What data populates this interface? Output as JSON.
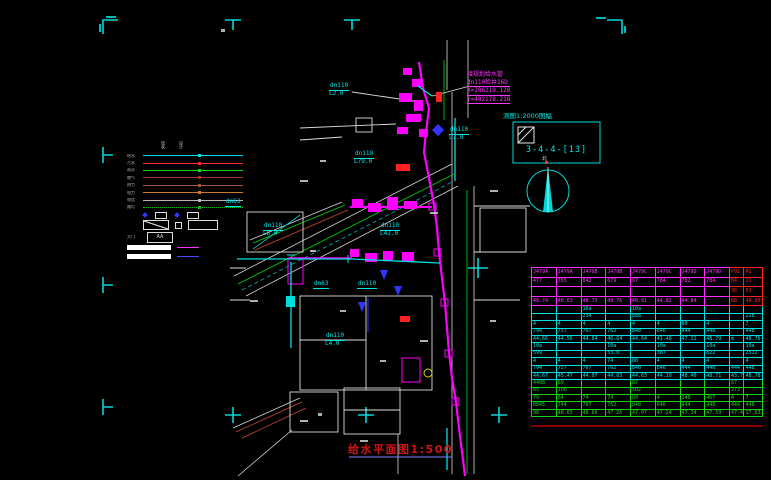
{
  "meta": {
    "background": "#000000",
    "accent_cyan": "#00e5e5",
    "accent_magenta": "#ff00ff",
    "accent_green": "#00d400",
    "accent_red": "#ff2020",
    "accent_white": "#e0e0e0"
  },
  "title": {
    "text": "给水平面图1:500"
  },
  "detail_box": {
    "scale_label": "测图1:2000图幅",
    "sheet_number": "3-4-4-[13]"
  },
  "compass": {
    "label": "北"
  },
  "coord_label": {
    "lines": [
      "接规划给水管",
      "dn110检井16D",
      "X=286219.128",
      "Y=482178.218"
    ]
  },
  "legend": {
    "header": [
      "现状",
      "设计"
    ],
    "lines": [
      {
        "label": "给水",
        "color": "#00e0e0",
        "dotted": false
      },
      {
        "label": "污水",
        "color": "#ff2a2a",
        "dotted": false
      },
      {
        "label": "雨水",
        "color": "#17d417",
        "dotted": false
      },
      {
        "label": "燃气",
        "color": "#a03828",
        "dotted": false
      },
      {
        "label": "热力",
        "color": "#a85535",
        "dotted": false
      },
      {
        "label": "电力",
        "color": "#cc7a2e",
        "dotted": false
      },
      {
        "label": "电信",
        "color": "#b8b8b8",
        "dotted": false
      },
      {
        "label": "路灯",
        "color": "#18b818",
        "dotted": true
      }
    ],
    "aa_row_label": "大门",
    "box_text": "AA"
  },
  "map_labels": [
    {
      "text": "dn110",
      "sub": "L2.0",
      "x": 329,
      "y": 83
    },
    {
      "text": "dn110",
      "sub": "L79.0",
      "x": 354,
      "y": 151
    },
    {
      "text": "dn110",
      "sub": "L7.0",
      "x": 449,
      "y": 127
    },
    {
      "text": "dn63",
      "sub": "",
      "x": 225,
      "y": 199
    },
    {
      "text": "dn110",
      "sub": "L8.0",
      "x": 263,
      "y": 223
    },
    {
      "text": "dn110",
      "sub": "L42.0",
      "x": 380,
      "y": 223
    },
    {
      "text": "dn63",
      "sub": "",
      "x": 313,
      "y": 281
    },
    {
      "text": "dn110",
      "sub": "",
      "x": 357,
      "y": 281
    },
    {
      "text": "dn110",
      "sub": "L4.0",
      "x": 325,
      "y": 333
    }
  ],
  "table": {
    "sections": [
      {
        "name": "existing-wells",
        "color": "#ff30ff",
        "red_last_cols": true,
        "rows": [
          [
            "J479A",
            "J479A",
            "J479B",
            "J479B",
            "J479C",
            "J479C",
            "J479D",
            "J479D",
            "P92",
            "P1"
          ],
          [
            "477",
            "765",
            "842",
            "679",
            "97",
            "784",
            "782",
            "784",
            "84",
            "21"
          ],
          [
            "",
            "",
            "",
            "",
            "",
            "",
            "",
            "",
            "36",
            "51"
          ],
          [
            "48.74",
            "48.63",
            "48.73",
            "48.76",
            "48.81",
            "44.82",
            "44.84",
            "",
            "88",
            "48.60"
          ]
        ]
      },
      {
        "name": "design-run-1",
        "color": "#00e0e0",
        "red_last_cols": false,
        "rows": [
          [
            "",
            "",
            "10a",
            "",
            "10a",
            "",
            "",
            "",
            "",
            ""
          ],
          [
            "",
            "",
            "234",
            "",
            "888",
            "",
            "",
            "",
            "",
            "228"
          ],
          [
            "4",
            "4",
            "4",
            "4",
            "4",
            "4",
            "80",
            "4",
            "",
            "7"
          ],
          [
            "794",
            "757",
            "767",
            "762",
            "840",
            "846",
            "444",
            "448",
            "",
            "448"
          ],
          [
            "44.66",
            "44.56",
            "44.84",
            "46.64",
            "44.64",
            "41.48",
            "47.11",
            "48.79",
            "m",
            "48.76"
          ]
        ]
      },
      {
        "name": "design-run-2",
        "color": "#00e0e0",
        "red_last_cols": false,
        "rows": [
          [
            "10a",
            "",
            "",
            "10a",
            "",
            "10a",
            "",
            "10a",
            "",
            "10a"
          ],
          [
            "599",
            "",
            "",
            "53.0",
            "",
            "387",
            "",
            "822",
            "",
            "2512"
          ],
          [
            "4",
            "4",
            "4",
            "74",
            "80",
            "4",
            "4",
            "4",
            "",
            "4"
          ],
          [
            "794",
            "757",
            "767",
            "762",
            "840",
            "846",
            "444",
            "448",
            "444",
            "448"
          ],
          [
            "44.67",
            "45.47",
            "44.07",
            "44.63",
            "44.63",
            "44.10",
            "48.40",
            "48.71",
            "43.74",
            "48.78"
          ]
        ]
      },
      {
        "name": "road-levels",
        "color": "#17d417",
        "red_last_cols": false,
        "rows": [
          [
            "4488",
            "89",
            "",
            "",
            "87",
            "",
            "",
            "",
            "87",
            ""
          ],
          [
            "85",
            "100",
            "",
            "",
            "502",
            "",
            "",
            "",
            "273",
            ""
          ],
          [
            "79",
            "84",
            "74",
            "74",
            "80",
            "4",
            "140",
            "467",
            "4",
            "7"
          ],
          [
            "8845",
            "744",
            "767",
            "762",
            "840",
            "846",
            "444",
            "448",
            "444",
            "448"
          ],
          [
            "98",
            "48.65",
            "48.66",
            "47.26",
            "47.07",
            "47.24",
            "47.34",
            "47.59",
            "47.49",
            "17.63"
          ]
        ]
      }
    ]
  }
}
